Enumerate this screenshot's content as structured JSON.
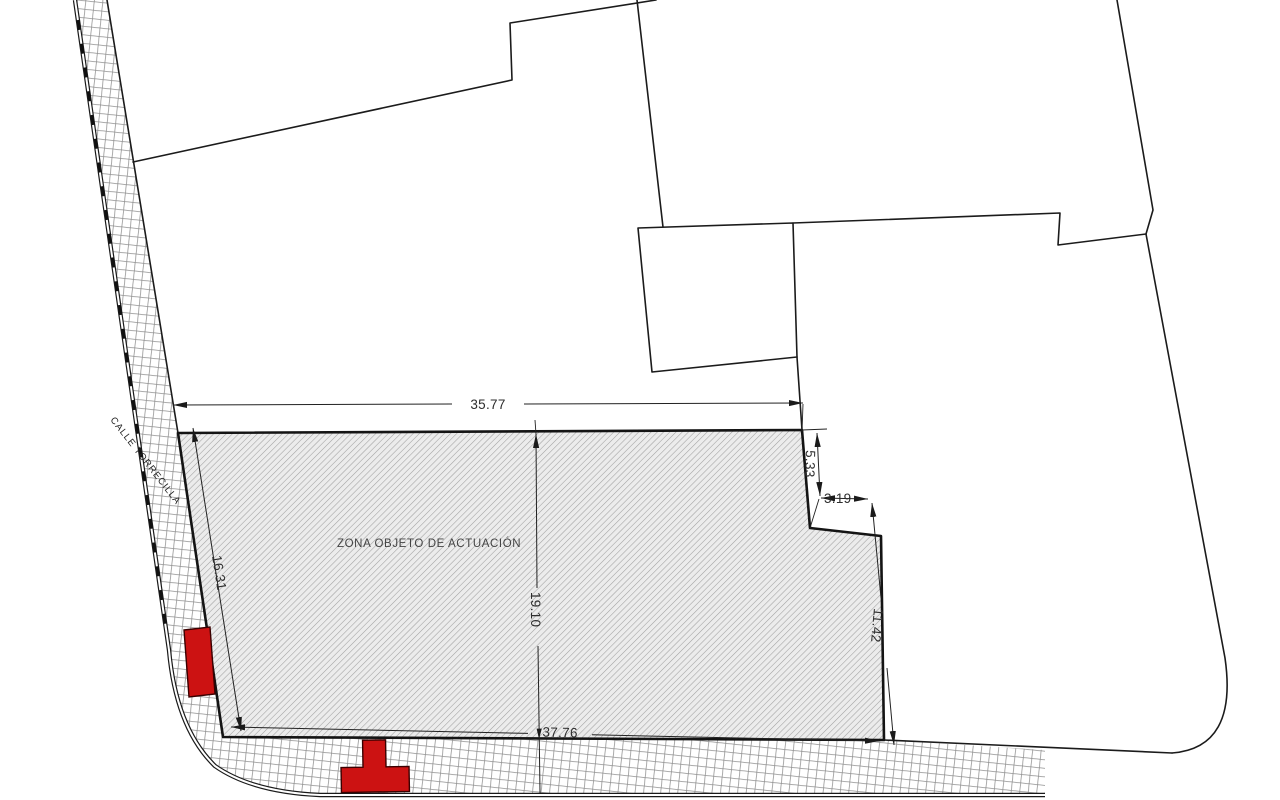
{
  "drawing": {
    "street_name": "CALLE TORRECILLA",
    "zone_label": "ZONA OBJETO DE ACTUACIÓN",
    "dimensions": {
      "top_width": "35.77",
      "left_depth": "16.31",
      "mid_depth": "19.10",
      "bottom_width": "37.76",
      "step_height": "5.33",
      "step_width": "3.19",
      "right_depth": "11.42"
    },
    "colors": {
      "highlight_red": "#cc1212",
      "line": "#1a1a1a",
      "zone_hatch": "#a3a3a3"
    }
  }
}
